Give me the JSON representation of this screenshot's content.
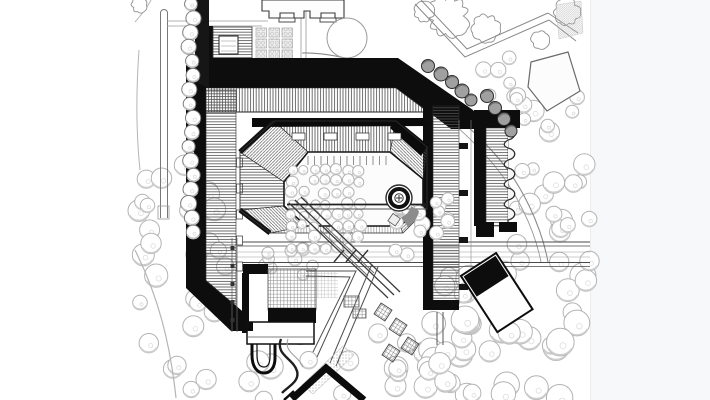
{
  "drawing": {
    "kind": "architectural-site-plan",
    "medium": "black-and-white-ink",
    "elements": [
      "courtyard-building",
      "inner-ring",
      "fountain",
      "tree-fields",
      "roads",
      "rotated-pavilion",
      "u-loop-drive",
      "walkways",
      "trellis-pavilions"
    ]
  },
  "palette": {
    "paper": "#ffffff",
    "margin_tint": "#f7f8fa",
    "ink": "#0d0d0d",
    "hatch": "#4e4e4e",
    "road_line": "#8a8a8a",
    "tree_outline": "#b3b3b3",
    "tree_shade": "#cdcdcd",
    "dark_tree_fill": "#a0a0a0"
  },
  "vegetation": {
    "clusters": [
      {
        "name": "left-field",
        "layer": "under",
        "x": [
          136,
          230
        ],
        "y": [
          165,
          398
        ],
        "count": 30,
        "r": [
          7,
          12
        ],
        "seed": 101
      },
      {
        "name": "bottom-center",
        "layer": "under",
        "x": [
          233,
          470
        ],
        "y": [
          330,
          400
        ],
        "count": 26,
        "r": [
          8,
          13
        ],
        "seed": 102
      },
      {
        "name": "bottom-right",
        "layer": "under",
        "x": [
          424,
          592
        ],
        "y": [
          270,
          400
        ],
        "count": 34,
        "r": [
          8,
          14
        ],
        "seed": 103
      },
      {
        "name": "east-field",
        "layer": "under",
        "x": [
          516,
          590
        ],
        "y": [
          92,
          268
        ],
        "count": 26,
        "r": [
          6,
          11
        ],
        "seed": 104
      },
      {
        "name": "northeast-pocket",
        "layer": "under",
        "x": [
          478,
          520
        ],
        "y": [
          56,
          100
        ],
        "count": 8,
        "r": [
          5,
          8
        ],
        "seed": 105
      },
      {
        "name": "southwest-pocket",
        "layer": "under",
        "x": [
          260,
          314
        ],
        "y": [
          238,
          284
        ],
        "count": 9,
        "r": [
          5.5,
          7.5
        ],
        "seed": 106
      },
      {
        "name": "courtyard-right",
        "layer": "courtyard",
        "x": [
          390,
          424
        ],
        "y": [
          206,
          256
        ],
        "count": 9,
        "r": [
          6,
          8.5
        ],
        "seed": 107
      },
      {
        "name": "ring-east-terrace",
        "layer": "courtyard",
        "x": [
          430,
          452
        ],
        "y": [
          176,
          258
        ],
        "count": 7,
        "r": [
          5.5,
          7
        ],
        "seed": 108
      }
    ],
    "courtyard_grid": {
      "x0": 292,
      "y0": 170,
      "cols": 7,
      "rows": 8,
      "step": 11.2,
      "r": 5.2,
      "jitter": 1.6,
      "seed": 109
    },
    "west_column": {
      "x": 191,
      "y0": 4,
      "y1": 232,
      "count": 17,
      "r": [
        6.2,
        8
      ],
      "seed": 110
    },
    "clouds": [
      {
        "cx": 448,
        "cy": 16,
        "r": 21,
        "bumps": 11,
        "seed": 121
      },
      {
        "cx": 486,
        "cy": 28,
        "r": 14,
        "bumps": 9,
        "seed": 122
      },
      {
        "cx": 424,
        "cy": 12,
        "r": 10,
        "bumps": 8,
        "seed": 123
      },
      {
        "cx": 567,
        "cy": 12,
        "r": 13,
        "bumps": 9,
        "seed": 124
      },
      {
        "cx": 540,
        "cy": 40,
        "r": 9,
        "bumps": 7,
        "seed": 125
      },
      {
        "cx": 139,
        "cy": 5,
        "r": 8,
        "bumps": 7,
        "seed": 126
      }
    ],
    "dark_trees": [
      [
        428,
        66,
        6.5
      ],
      [
        441,
        74,
        7
      ],
      [
        452,
        82,
        6.5
      ],
      [
        462,
        91,
        7
      ],
      [
        471,
        100,
        6
      ],
      [
        487,
        96,
        6.5
      ],
      [
        495,
        108,
        6.5
      ],
      [
        504,
        119,
        6.5
      ],
      [
        511,
        131,
        6
      ]
    ]
  },
  "courtyard": {
    "colonnade_ticks": {
      "x0": 308,
      "x1": 390,
      "step": 6.5,
      "y0": 156,
      "y1": 165
    }
  }
}
